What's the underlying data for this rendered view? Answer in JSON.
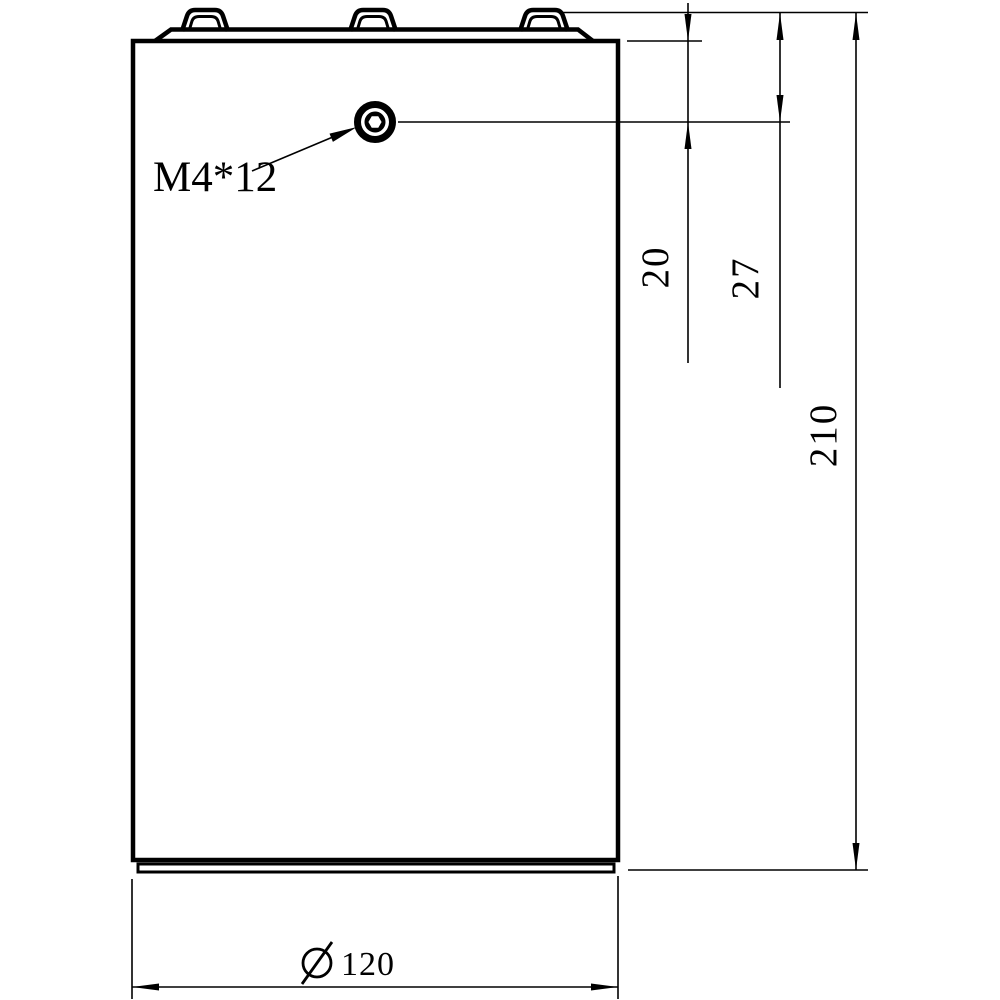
{
  "drawing": {
    "type": "engineering-dimension-drawing",
    "view": "front view of cylindrical part with top terminals",
    "background_color": "#ffffff",
    "line_color": "#000000",
    "callout": {
      "text": "M4*12",
      "target": "hex-socket-screw"
    },
    "dimensions": {
      "d20": {
        "value": "20",
        "orientation": "vertical",
        "from": "cap-base",
        "to": "screw-center"
      },
      "d27": {
        "value": "27",
        "orientation": "vertical",
        "from": "tab-top",
        "to": "screw-center"
      },
      "d210": {
        "value": "210",
        "orientation": "vertical",
        "from": "tab-top",
        "to": "bottom-rim"
      },
      "d120": {
        "value": "120",
        "orientation": "horizontal",
        "symbol": "diameter",
        "from": "left-edge",
        "to": "right-edge"
      }
    },
    "icons": {
      "screw": "hex-socket-screw-icon",
      "diameter": "diameter-symbol-icon"
    }
  }
}
